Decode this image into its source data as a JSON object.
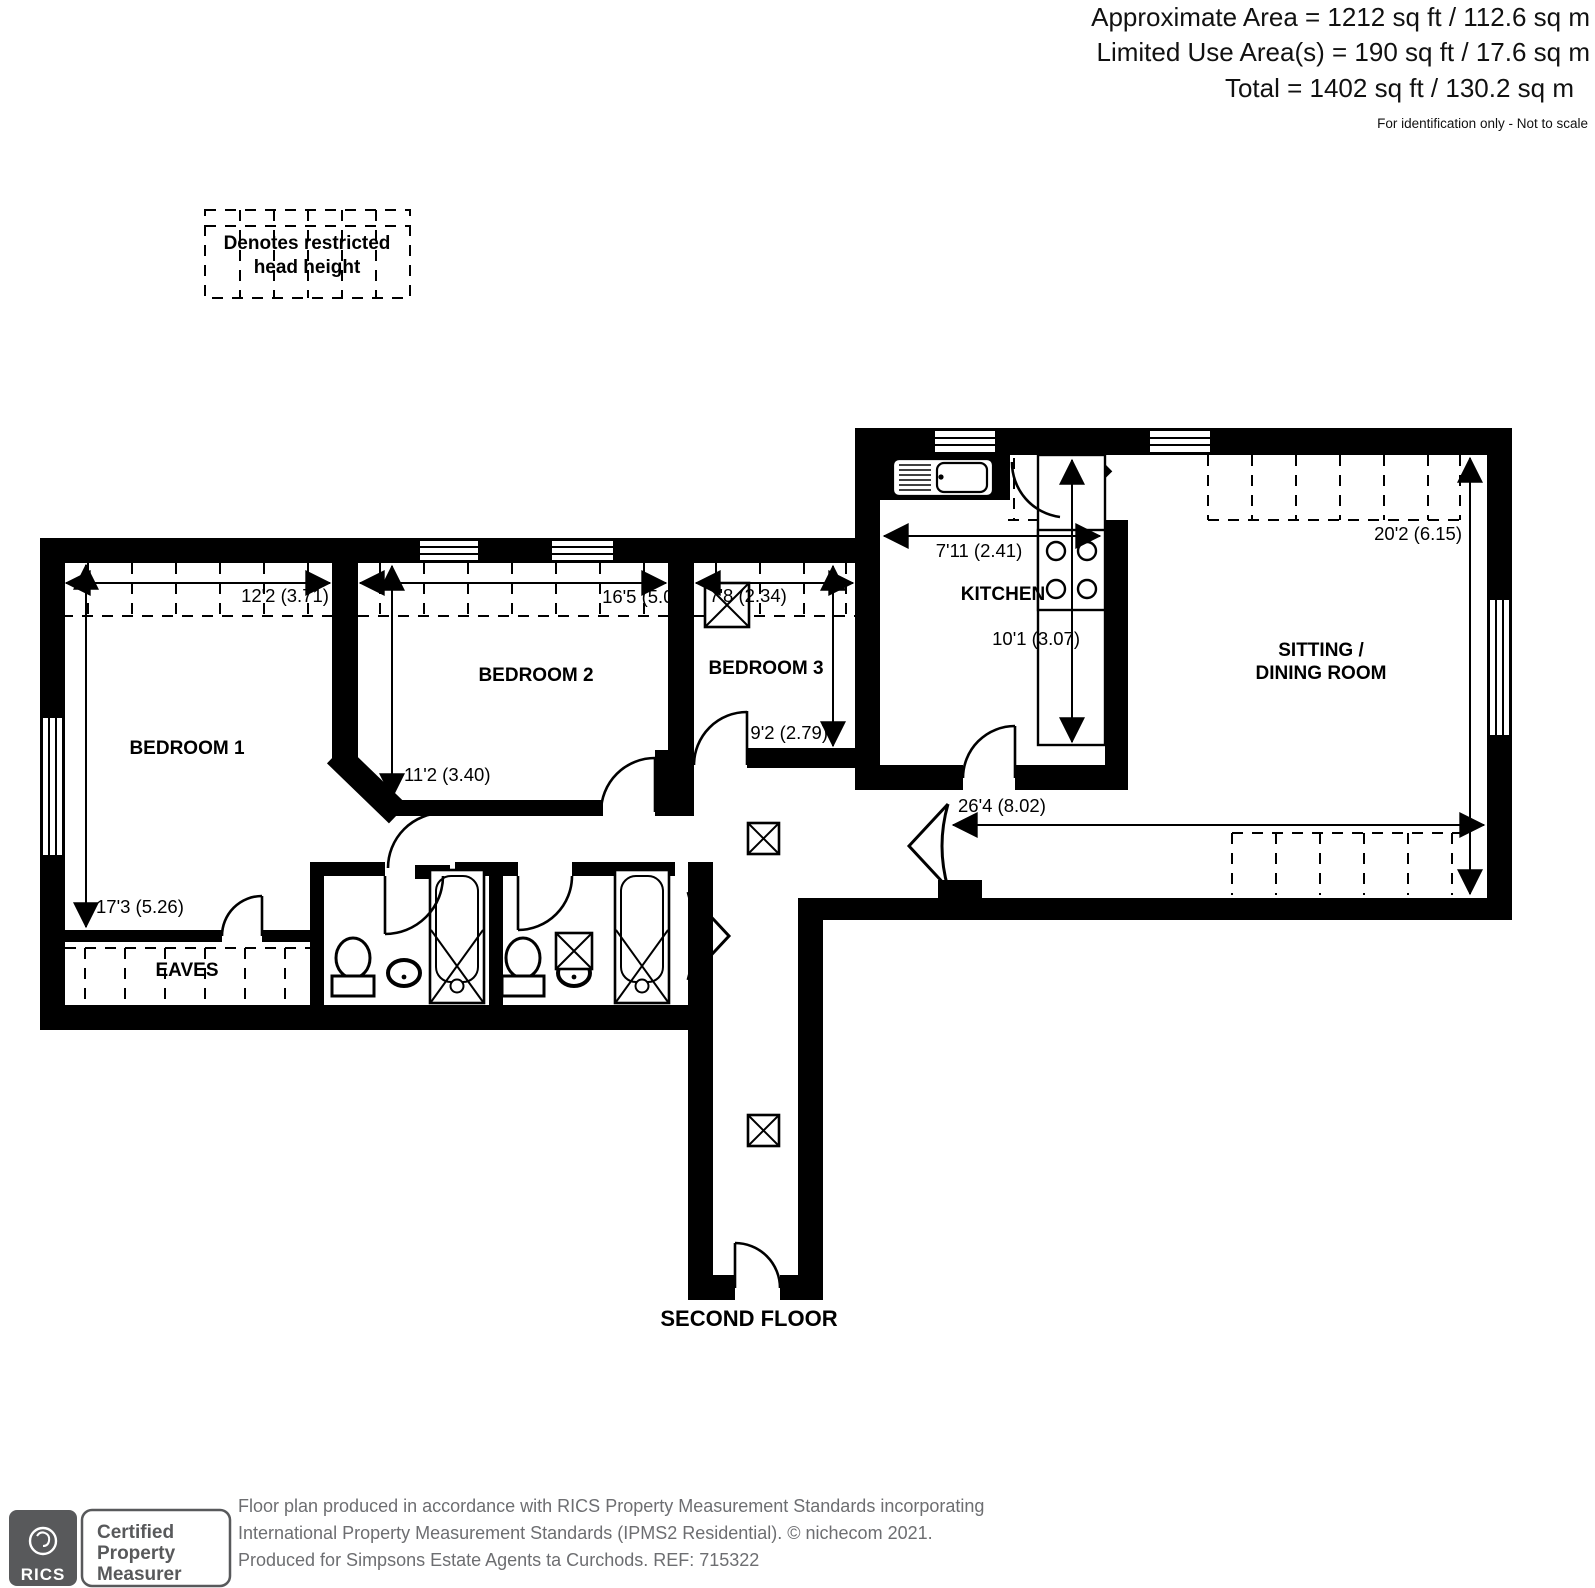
{
  "header": {
    "approximate_area": "Approximate Area = 1212 sq ft / 112.6 sq m",
    "limited_use_area": "Limited Use Area(s) = 190 sq ft / 17.6 sq m",
    "total_area": "Total = 1402 sq ft / 130.2 sq m",
    "disclaimer": "For identification only - Not to scale"
  },
  "legend": {
    "line1": "Denotes restricted",
    "line2": "head height"
  },
  "rooms": {
    "bedroom1": {
      "name": "BEDROOM 1",
      "width": "12'2 (3.71)",
      "depth": "17'3 (5.26)"
    },
    "bedroom2": {
      "name": "BEDROOM 2",
      "width": "16'5 (5.00)",
      "depth": "11'2 (3.40)"
    },
    "bedroom3": {
      "name": "BEDROOM 3",
      "width": "7'8 (2.34)",
      "depth": "9'2 (2.79)"
    },
    "kitchen": {
      "name": "KITCHEN",
      "width": "7'11 (2.41)",
      "depth": "10'1 (3.07)"
    },
    "sitting_dining": {
      "name_line1": "SITTING /",
      "name_line2": "DINING ROOM",
      "width": "26'4 (8.02)",
      "depth": "20'2 (6.15)"
    },
    "eaves": {
      "name": "EAVES"
    }
  },
  "floor": {
    "label": "SECOND FLOOR"
  },
  "footer": {
    "rics_logo": "RICS",
    "badge": {
      "line1": "Certified",
      "line2": "Property",
      "line3": "Measurer"
    },
    "line1": "Floor plan produced in accordance with RICS Property Measurement Standards incorporating",
    "line2": "International Property Measurement Standards (IPMS2 Residential).   © nichecom 2021.",
    "line3": "Produced for Simpsons Estate Agents ta Curchods.   REF:  715322"
  },
  "colors": {
    "plan": "#000000",
    "footer_gray": "#6d6e71",
    "rics_gray": "#58595b"
  }
}
